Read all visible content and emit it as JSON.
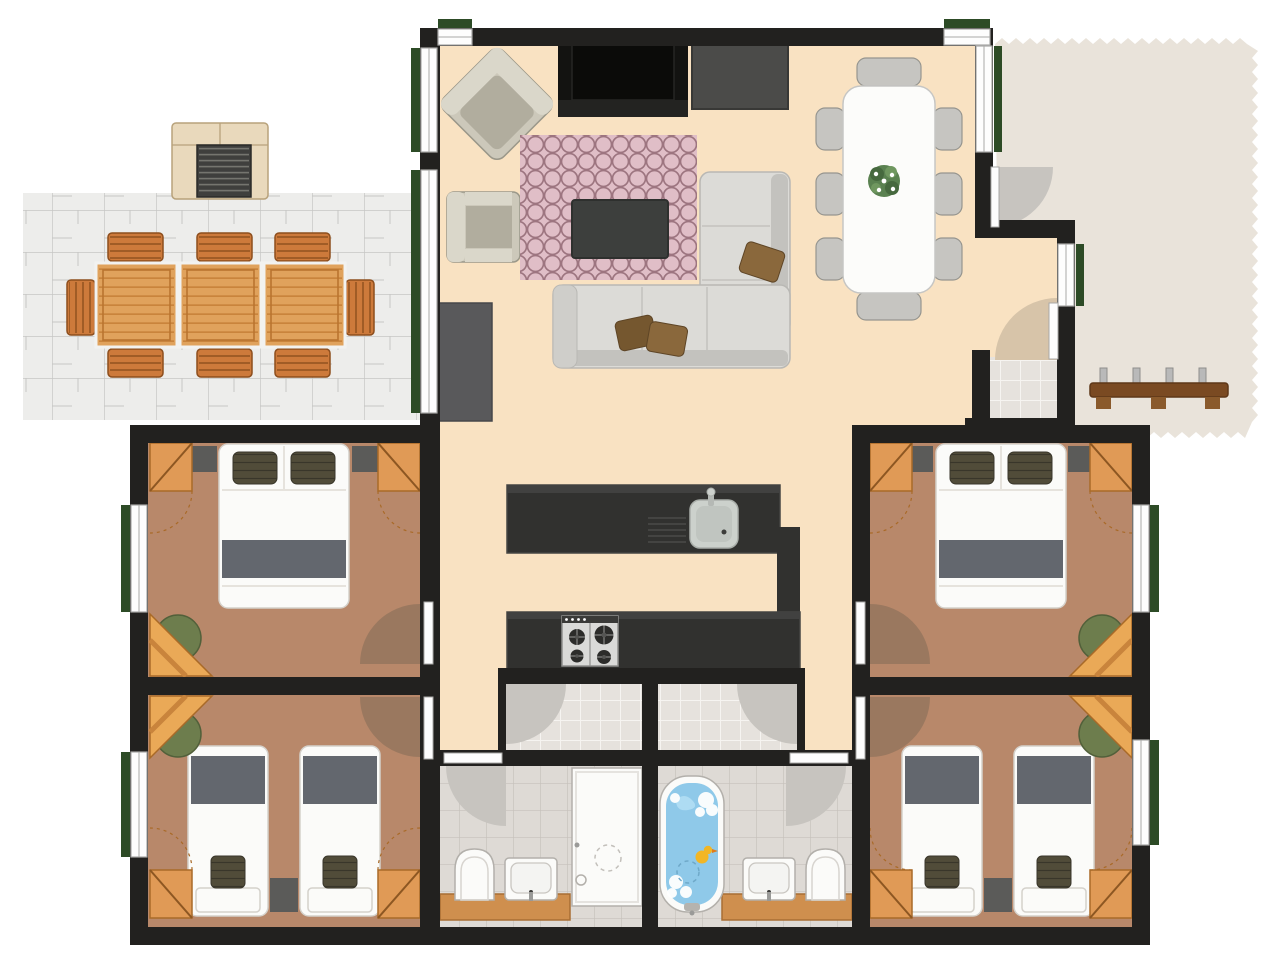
{
  "meta": {
    "title": "apartment-floor-plan",
    "canvas_width": 1280,
    "canvas_height": 963
  },
  "colors": {
    "bg": "#ffffff",
    "wall": "#22211f",
    "floor_main": "#f9e2c2",
    "floor_bedroom": "#b8886a",
    "arc_bedroom": "#9a785f",
    "arc_gray": "#c7c4bf",
    "arc_tan": "#d7c4a9",
    "patio": "#ededeb",
    "patio_line": "#c6c6c4",
    "walkway": "#e9e3da",
    "tile_bath": "#dedad5",
    "tile_bath_line": "#c6c1bb",
    "tile_entry": "#e6e2dd",
    "tile_entry_line": "#f6f4f1",
    "window_green": "#2d4b26",
    "leaf_white": "#fdfdfd",
    "frame_line": "#a9a9a7",
    "wardrobe": "#e09a56",
    "wardrobe_dark": "#a96a28",
    "desk": "#eaa957",
    "chair_green": "#6d7d4d",
    "chair_green_dark": "#52603a",
    "bed_white": "#fbfbf9",
    "bed_stroke": "#d4d1cb",
    "bed_stripe": "#63676e",
    "pillow": "#514c39",
    "pillow_dark": "#39362a",
    "mat_dark": "#5b5b59",
    "counter_dark": "#31312f",
    "counter_edge": "#454543",
    "steel": "#dadad8",
    "steel_dark": "#8f8f8d",
    "burner": "#2c2c2a",
    "sink": "#ccd1cc",
    "sink_dark": "#a9aea9",
    "sofa": "#dcdbd7",
    "sofa_dark": "#c3c2be",
    "sofa_arm": "#cfceca",
    "cushion_brown": "#8a683c",
    "cushion_brown2": "#75572f",
    "armchair": "#ccc8ba",
    "armchair_back": "#dad7ca",
    "armchair_seat": "#b1ad9e",
    "armchair_line": "#9a9789",
    "rug": "#e0bec7",
    "rug_line": "#9d7580",
    "table_dark": "#3d3f3d",
    "tv_black": "#131311",
    "tv_inner": "#0b0b09",
    "tv_gray": "#4b4b49",
    "sideboard": "#59595b",
    "dining_white": "#fcfcfa",
    "chair_gray": "#c6c5c1",
    "chair_gray_dark": "#96958f",
    "wood_table": "#e0a25c",
    "wood_line": "#c9843c",
    "wood_dark": "#b9742f",
    "wood_chair": "#cd7a3b",
    "wood_chair_dark": "#8d4e1d",
    "grill_body": "#e9d9bc",
    "grill_edge": "#b8a27b",
    "grate": "#3f3f3d",
    "grate_line": "#75756f",
    "bench_wood": "#7a4a22",
    "bench_dark": "#5e3718",
    "peg": "#b9b9b9",
    "foot_wood": "#8a5a2c",
    "tub_water": "#8fc9e9",
    "tub_water_hi": "#aedcf3",
    "duck": "#f2b624",
    "duck_beak": "#e07b1a",
    "fixture_stroke": "#b3b0ab",
    "counter_wood": "#cf8f4e",
    "counter_wood_dark": "#a86e34"
  },
  "rooms": {
    "living_room": {
      "label": "living-room",
      "furniture": [
        "corner-armchair",
        "armchair",
        "tv-lowboard",
        "wall-screen",
        "circle-pattern-rug",
        "coffee-table",
        "corner-sofa",
        "sideboard",
        "brown-cushions"
      ]
    },
    "dining_area": {
      "label": "dining-area",
      "furniture": [
        "dining-table",
        "dining-chairs-x8",
        "centerpiece-plant"
      ]
    },
    "kitchen": {
      "label": "kitchen",
      "furniture": [
        "island-counter-with-sink",
        "counter-with-gas-hob-4-burners"
      ]
    },
    "bedroom_top_left": {
      "label": "double-bedroom-left",
      "furniture": [
        "double-bed",
        "pillows-x2",
        "bedside-mats-x2",
        "wardrobes-x2",
        "corner-desk",
        "green-chair"
      ]
    },
    "bedroom_bottom_left": {
      "label": "twin-bedroom-left",
      "furniture": [
        "single-beds-x2",
        "nightstand",
        "wardrobes-x2",
        "corner-desk",
        "green-chair"
      ]
    },
    "bedroom_top_right": {
      "label": "double-bedroom-right",
      "furniture": [
        "double-bed",
        "pillows-x2",
        "bedside-mats-x2",
        "wardrobes-x2",
        "corner-desk",
        "green-chair"
      ]
    },
    "bedroom_bottom_right": {
      "label": "twin-bedroom-right",
      "furniture": [
        "single-beds-x2",
        "nightstand",
        "wardrobes-x2",
        "corner-desk",
        "green-chair"
      ]
    },
    "bathroom_left": {
      "label": "shower-bathroom",
      "furniture": [
        "toilet",
        "washbasin",
        "shower-cabin",
        "wood-counter"
      ]
    },
    "bathroom_right": {
      "label": "bathtub-bathroom",
      "furniture": [
        "bathtub-with-duck",
        "washbasin",
        "toilet",
        "wood-counter"
      ]
    },
    "halls": {
      "label": "bathroom-halls",
      "furniture": []
    },
    "entry": {
      "label": "entry-vestibule",
      "furniture": []
    },
    "patio": {
      "label": "patio-terrace",
      "furniture": [
        "bbq-grill",
        "outdoor-table-x3-sections",
        "outdoor-chairs-x8"
      ]
    },
    "walkway": {
      "label": "entry-walkway",
      "furniture": [
        "coat-rack-bench"
      ]
    }
  }
}
